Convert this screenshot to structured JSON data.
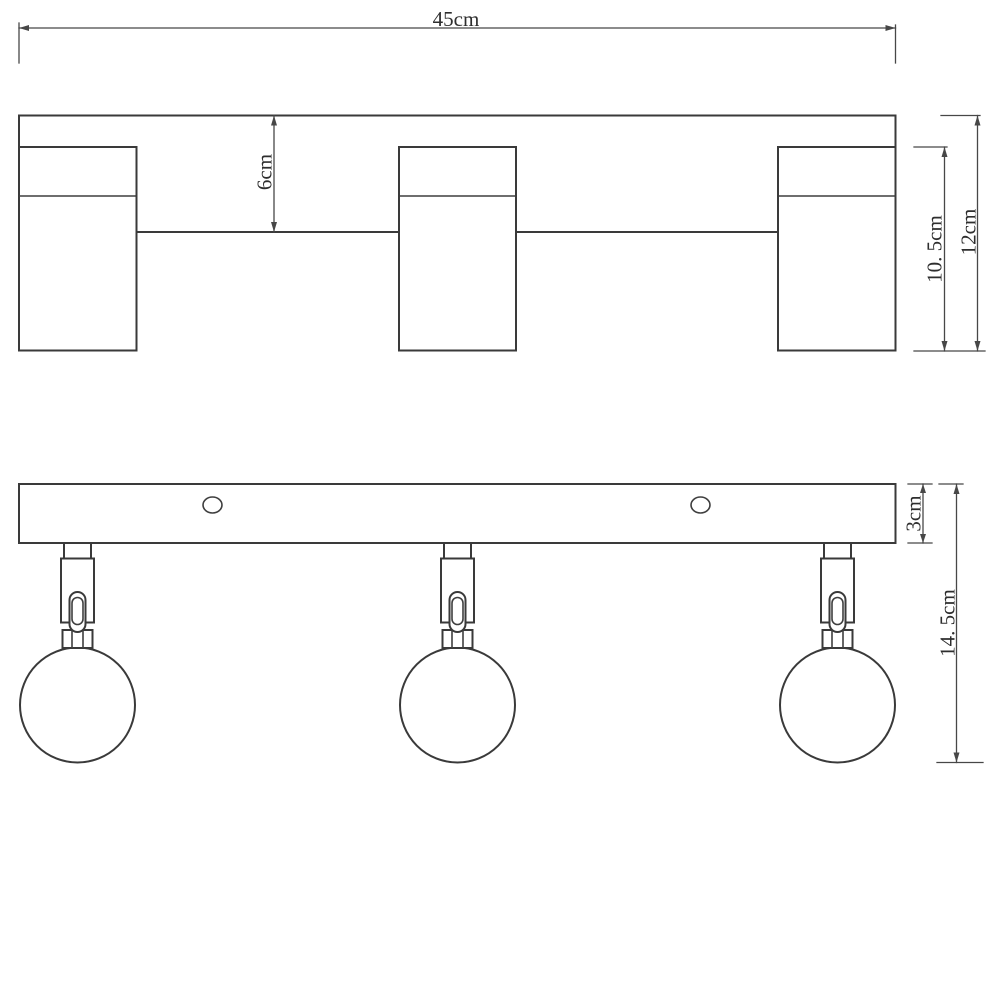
{
  "diagram": {
    "title": "three-head-spotlight-bar-dimension-drawing",
    "colors": {
      "background": "#ffffff",
      "line": "#3a3a3a",
      "dimension_line": "#474747",
      "label_text": "#2e2e2e"
    },
    "views": {
      "top_profile": "top-profile-view",
      "front": "front-view"
    },
    "dimensions": {
      "overall_width": "45cm",
      "canopy_depth": "6cm",
      "spot_body_height": "10. 5cm",
      "overall_depth": "12cm",
      "bar_thickness": "3cm",
      "total_drop_height": "14. 5cm"
    }
  }
}
